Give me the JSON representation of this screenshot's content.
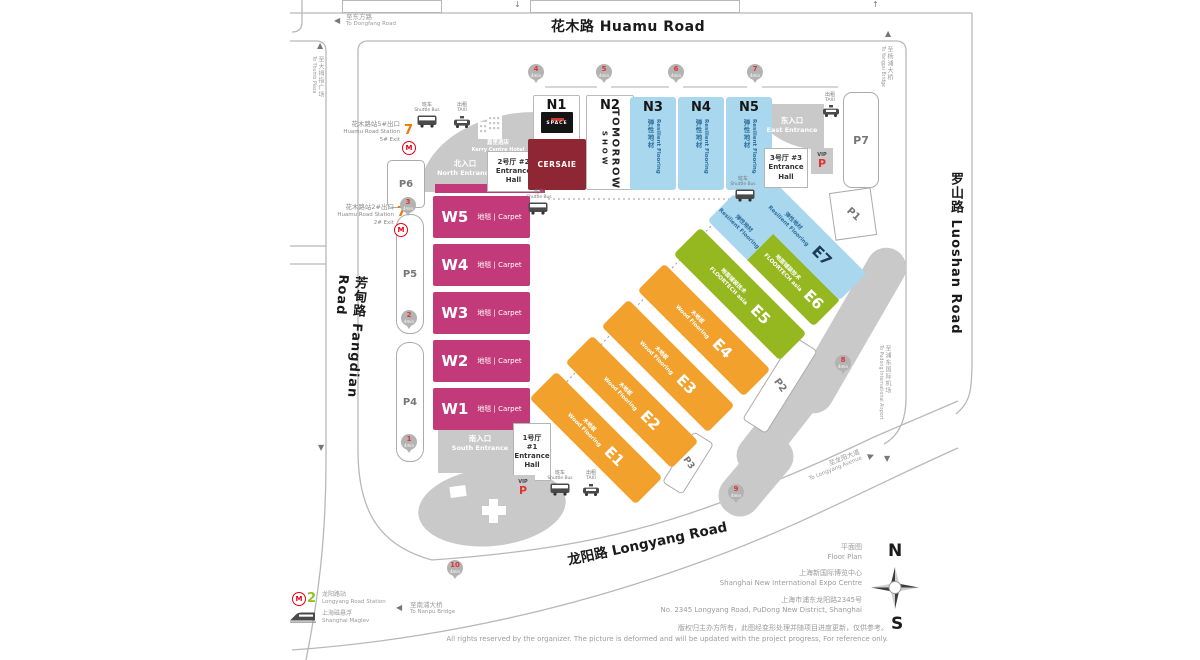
{
  "colors": {
    "magenta": "#c23a7a",
    "orange": "#f2a12d",
    "green": "#95b71f",
    "lightblue": "#a9d7ee",
    "maroon": "#8e2733",
    "metro_red": "#e60012",
    "line7_orange": "#ee7800",
    "line2_green": "#8fc31f",
    "pin_red": "#e23333",
    "gray": "#c9c9c9"
  },
  "roads": {
    "huamu": "花木路 Huamu Road",
    "fangdian": "芳甸路 Fangdian Road",
    "luoshan": "罗山路 Luoshan Road",
    "longyang": "龙阳路 Longyang Road"
  },
  "directions": {
    "dongfang": {
      "zh": "至东方路",
      "en": "To Dongfang Road"
    },
    "thumb": {
      "zh": "至大拇指广场",
      "en": "To Thumb Plaza"
    },
    "yangpu": {
      "zh": "至杨浦大桥",
      "en": "To Yangpu Bridge"
    },
    "airport": {
      "zh": "至浦东国际机场",
      "en": "To Pudong International Airport"
    },
    "nanpu": {
      "zh": "至南浦大桥",
      "en": "To Nanpu Bridge"
    },
    "longyang_ave": {
      "zh": "至龙阳大道",
      "en": "To Longyang Avenue"
    }
  },
  "stations": {
    "huamu5": {
      "line": "7",
      "zh": "花木路站5#出口",
      "en": "Huamu Road Station",
      "exit": "5# Exit"
    },
    "huamu2": {
      "line": "7",
      "zh": "花木路站2#出口",
      "en": "Huamu Road Station",
      "exit": "2# Exit"
    },
    "longyang": {
      "line": "2",
      "zh": "龙阳路站",
      "en": "Longyang Road Station"
    },
    "maglev": {
      "zh": "上海磁悬浮",
      "en": "Shanghai Maglev"
    }
  },
  "entrances": {
    "north": {
      "zh": "北入口",
      "en": "North Entrance"
    },
    "south": {
      "zh": "南入口",
      "en": "South Entrance"
    },
    "east": {
      "zh": "东入口",
      "en": "East Entrance"
    }
  },
  "entrance_halls": {
    "h1": {
      "label": "1号厅 #1",
      "en": "Entrance Hall"
    },
    "h2": {
      "label": "2号厅 #2",
      "en": "Entrance Hall"
    },
    "h3": {
      "label": "3号厅 #3",
      "en": "Entrance Hall"
    }
  },
  "hotel": {
    "zh": "嘉里酒店",
    "en": "Kerry Centre Hotel"
  },
  "transit": {
    "shuttle": {
      "zh": "班车",
      "en": "Shuttle Bus"
    },
    "taxi": {
      "zh": "出租",
      "en": "TAXI"
    }
  },
  "vip": {
    "label": "VIP",
    "p": "P"
  },
  "parking": {
    "p1": "P1",
    "p2": "P2",
    "p3": "P3",
    "p4": "P4",
    "p5": "P5",
    "p6": "P6",
    "p7": "P7"
  },
  "halls": {
    "north": [
      {
        "code": "N1",
        "badge": "SPACE",
        "box": "CERSAIE"
      },
      {
        "code": "N2",
        "logo_line1": "TOMORROW",
        "logo_line2": "SHOW"
      },
      {
        "code": "N3",
        "zh": "弹性地材",
        "en": "Resilient Flooring"
      },
      {
        "code": "N4",
        "zh": "弹性地材",
        "en": "Resilient Flooring"
      },
      {
        "code": "N5",
        "zh": "弹性地材",
        "en": "Resilient Flooring"
      }
    ],
    "west": [
      {
        "code": "W5",
        "label": "地毯 | Carpet"
      },
      {
        "code": "W4",
        "label": "地毯 | Carpet"
      },
      {
        "code": "W3",
        "label": "地毯 | Carpet"
      },
      {
        "code": "W2",
        "label": "地毯 | Carpet"
      },
      {
        "code": "W1",
        "label": "地毯 | Carpet"
      }
    ],
    "east": [
      {
        "code": "E1",
        "zh": "木地板",
        "en": "Wood Flooring"
      },
      {
        "code": "E2",
        "zh": "木地板",
        "en": "Wood Flooring"
      },
      {
        "code": "E3",
        "zh": "木地板",
        "en": "Wood Flooring"
      },
      {
        "code": "E4",
        "zh": "木地板",
        "en": "Wood Flooring"
      },
      {
        "code": "E5",
        "zh": "地面铺装技术",
        "en": "FLOORTECH asia"
      },
      {
        "code": "E6",
        "zh": "地面铺装技术",
        "en": "FLOORTECH asia",
        "zh2": "弹性地材",
        "en2": "Resilient Flooring"
      },
      {
        "code": "E7",
        "zh": "弹性地材",
        "en": "Resilient Flooring"
      }
    ]
  },
  "pins": [
    {
      "n": "1",
      "t": "4min"
    },
    {
      "n": "2",
      "t": "4min"
    },
    {
      "n": "3",
      "t": "4min"
    },
    {
      "n": "4",
      "t": "4min"
    },
    {
      "n": "5",
      "t": "4min"
    },
    {
      "n": "6",
      "t": "4min"
    },
    {
      "n": "7",
      "t": "4min"
    },
    {
      "n": "8",
      "t": "4min"
    },
    {
      "n": "9",
      "t": "4min"
    },
    {
      "n": "10",
      "t": "4min"
    }
  ],
  "compass": {
    "n": "N",
    "s": "S"
  },
  "footer": {
    "zh1": "平面图",
    "en1": "Floor Plan",
    "zh2": "上海新国际博览中心",
    "en2": "Shanghai New International Expo Centre",
    "zh3": "上海市浦东龙阳路2345号",
    "en3": "No. 2345 Longyang Road, PuDong New District, Shanghai",
    "zh4": "版权归主办方所有，此图经变形处理并随项目进度更新，仅供参考。",
    "en4": "All rights reserved by the organizer. The picture is deformed and will be updated with the project progress, For reference only."
  }
}
